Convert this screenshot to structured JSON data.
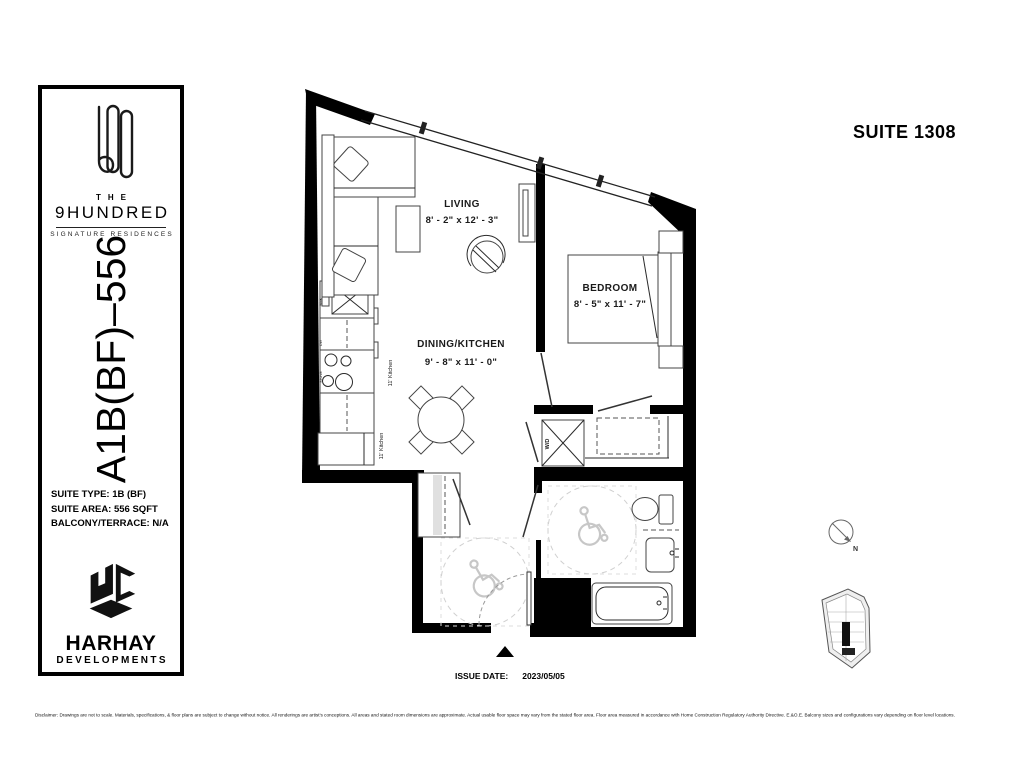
{
  "colors": {
    "wall": "#000000",
    "line": "#444444",
    "accessibility": "#c7c7c7"
  },
  "sidebar": {
    "brand_the": "THE",
    "brand_name": "9HUNDRED",
    "brand_tagline": "SIGNATURE RESIDENCES",
    "model_code": "A1B(BF)–556",
    "suite_type": "SUITE TYPE: 1B (BF)",
    "suite_area": "SUITE AREA: 556 SQFT",
    "balcony": "BALCONY/TERRACE: N/A",
    "developer_name": "HARHAY",
    "developer_sub": "DEVELOPMENTS"
  },
  "header": {
    "suite_label": "SUITE 1308"
  },
  "plan": {
    "living": {
      "name": "LIVING",
      "dims": "8' - 2\" x 12' - 3\""
    },
    "bedroom": {
      "name": "BEDROOM",
      "dims": "8' - 5\" x 11' - 7\""
    },
    "dining_kitchen": {
      "name": "DINING/KITCHEN",
      "dims": "9' - 8\" x 11' - 0\""
    },
    "wd_label": "W/D",
    "kitchen_note_1": "11' Kitchen",
    "kitchen_note_2": "11' Kitchen",
    "sink_label": "SINK",
    "dw_label": "DW",
    "stove_label": "STOVE"
  },
  "compass": {
    "north_label": "N"
  },
  "footer": {
    "issue_date_label": "ISSUE DATE:",
    "issue_date_value": "2023/05/05",
    "disclaimer": "Disclaimer: Drawings are not to scale. Materials, specifications, & floor plans are subject to change without notice. All renderings are artist's conceptions. All areas and stated room dimensions are approximate. Actual usable floor space may vary from the stated floor area. Floor area measured in accordance with Home Construction Regulatory Authority Directive. E.&O.E. Balcony sizes and configurations vary depending on floor level locations."
  }
}
